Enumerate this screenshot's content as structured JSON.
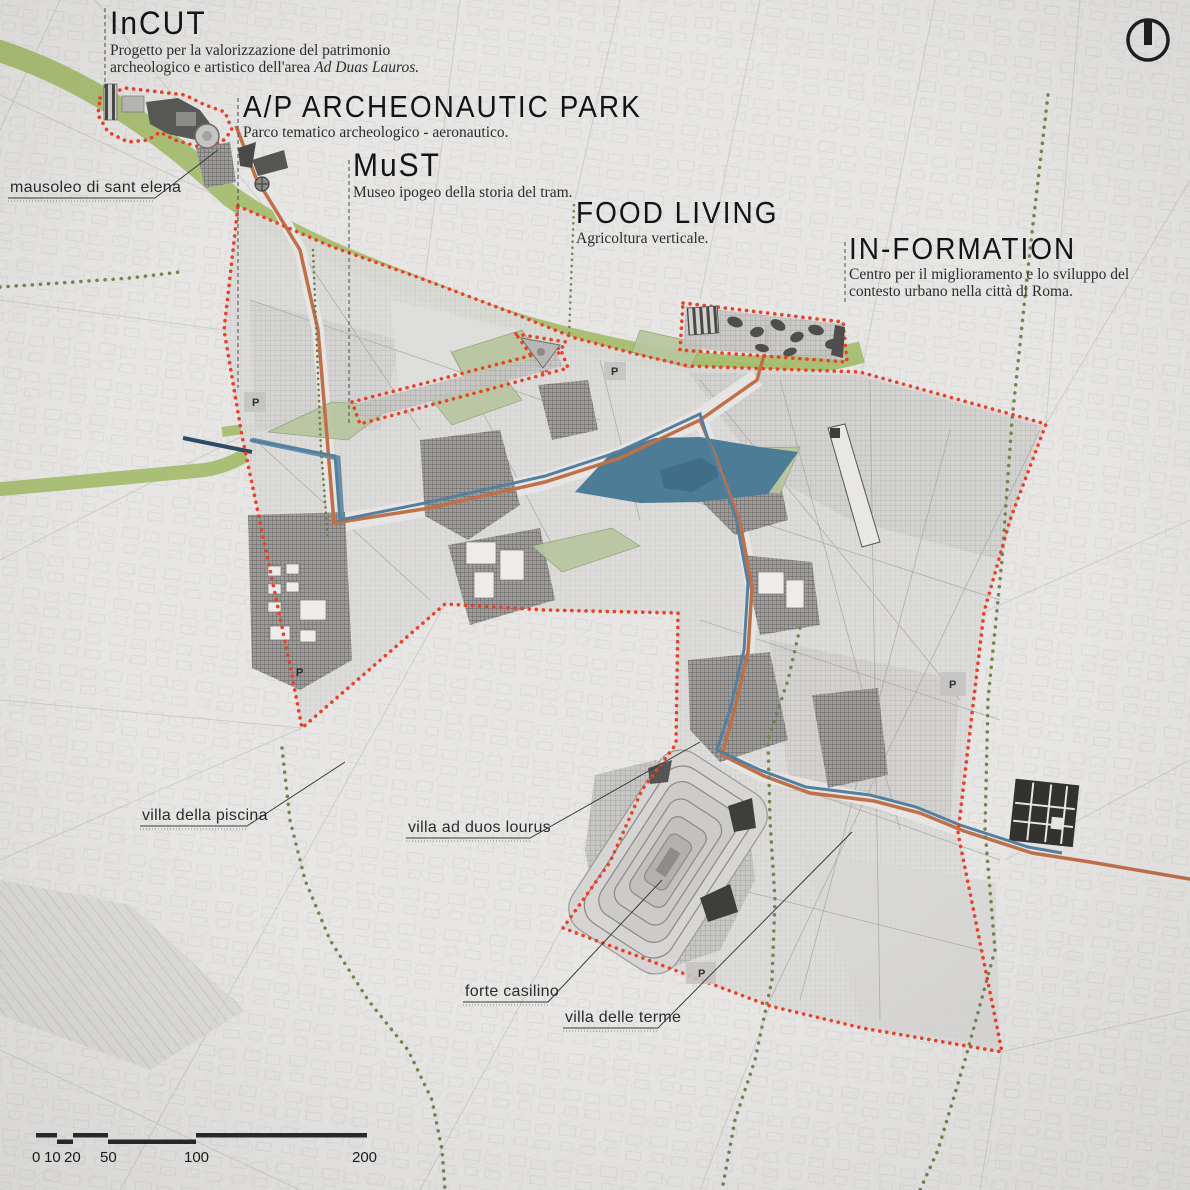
{
  "projects": {
    "incut": {
      "title": "InCUT",
      "desc1": "Progetto per la valorizzazione del patrimonio",
      "desc2": "archeologico e artistico dell'area ",
      "desc2_italic": "Ad Duas Lauros."
    },
    "archeonautic": {
      "title": "A/P ARCHEONAUTIC PARK",
      "desc": "Parco tematico archeologico - aeronautico."
    },
    "must": {
      "title": "MuST",
      "desc": "Museo ipogeo della storia del tram."
    },
    "food_living": {
      "title": "FOOD LIVING",
      "desc": "Agricoltura verticale."
    },
    "information": {
      "title": "IN-FORMATION",
      "desc1": "Centro per il miglioramento e lo sviluppo del",
      "desc2": "contesto urbano nella città di Roma."
    }
  },
  "map_labels": {
    "mausoleo": "mausoleo di sant elena",
    "villa_piscina": "villa della piscina",
    "villa_ad_duos": "villa ad duos lourus",
    "forte_casilino": "forte casilino",
    "villa_terme": "villa delle terme"
  },
  "parking": {
    "symbol": "P"
  },
  "scalebar": {
    "v0": "0",
    "v10": "10",
    "v20": "20",
    "v50": "50",
    "v100": "100",
    "v200": "200"
  },
  "colors": {
    "site_boundary": "#e8432a",
    "green_corridor": "#a5bc6c",
    "water": "#4d7c97",
    "route_tram": "#c07048",
    "route_water": "#54809f",
    "olive_dots": "#76854e"
  }
}
